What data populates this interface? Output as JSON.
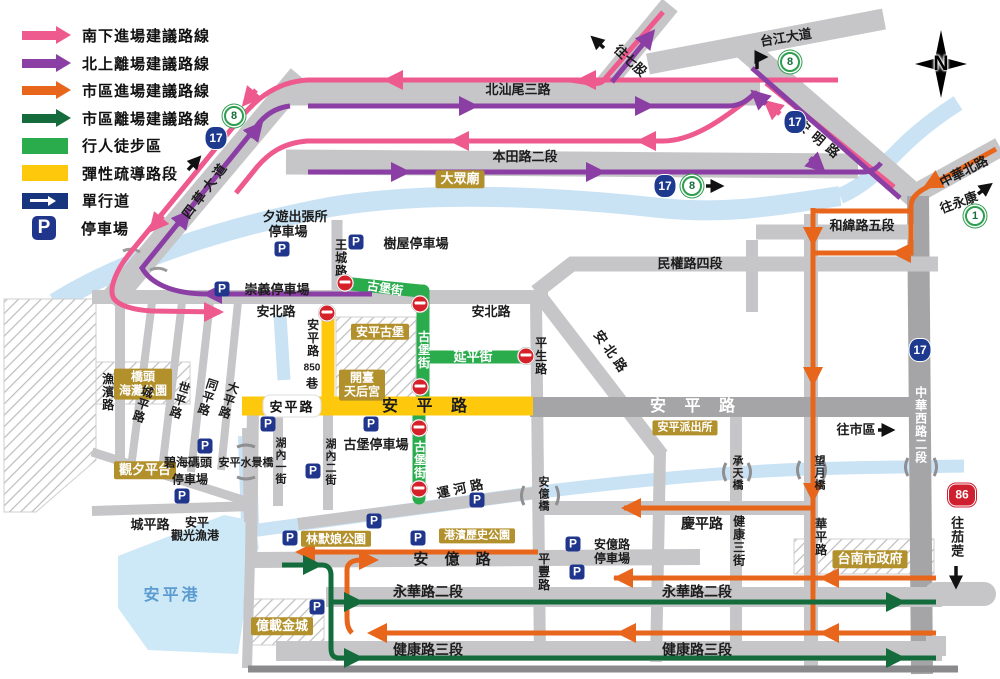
{
  "colors": {
    "pink": "#ee5a8e",
    "purple": "#8b3fa5",
    "orange": "#e8651c",
    "dark_green": "#146c3c",
    "pedestrian_green": "#2aac4d",
    "flex_yellow": "#fec80d",
    "oneway_navy": "#17357e",
    "parking_navy": "#20368c",
    "road_gray": "#c6c6c8",
    "water_blue": "#c9e3f5",
    "landmark_gold": "#b2902b",
    "noentry_red": "#d6202a"
  },
  "icons": {
    "parking": "P"
  },
  "compass": {
    "label": "N"
  },
  "shields": {
    "hw17": "17",
    "hw8": "8",
    "hw1": "1",
    "hw86": "86"
  },
  "legend": {
    "items": [
      {
        "label": "南下進場建議路線"
      },
      {
        "label": "北上離場建議路線"
      },
      {
        "label": "市區進場建議路線"
      },
      {
        "label": "市區離場建議路線"
      },
      {
        "label": "行人徒步區"
      },
      {
        "label": "彈性疏導路段"
      },
      {
        "label": "單行道"
      },
      {
        "label": "停車場"
      }
    ]
  },
  "labels": {
    "beishanwei": "北汕尾三路",
    "bentian": "本田路二段",
    "taijiang": "台江大道",
    "wangqigu": "往七股",
    "anming": "安明路",
    "sicao": "四草大道",
    "dazhong": "大眾廟",
    "zhonghuabei": "中華北路",
    "wangyongkang": "往永康",
    "hewei": "和緯路五段",
    "minquan": "民權路四段",
    "anbei1": "安北路",
    "anbei2": "安北路",
    "anbeid": "安北路",
    "chongyi": "崇義停車場",
    "xiyou1": "夕遊出張所",
    "xiyou2": "停車場",
    "wangcheng": "王城路",
    "shuwu": "樹屋停車場",
    "gubao_n": "古堡街",
    "gubao_v": "古堡街",
    "gubao_s": "古堡街",
    "yanping": "延平街",
    "pingsheng": "平生路",
    "l850a": "安平路",
    "l850b": "850",
    "l850c": "巷",
    "anpinggubao": "安平古堡",
    "kaitai1": "開臺",
    "kaitai2": "天后宮",
    "ap_box": "安平路",
    "ap_yellow": "安 平 路",
    "ap_east": "安 平 路",
    "paichusuo": "安平派出所",
    "wangshiqu": "往市區",
    "zhonghuaxi": "中華西路二段",
    "qiaotou1": "橋頭",
    "qiaotou2": "海灘公園",
    "yubin": "漁濱路",
    "chengping_d": "城平路",
    "shiping": "世平路",
    "tongping": "同平路",
    "daping": "大平路",
    "guanxi": "觀夕平台",
    "bihai1": "碧海碼頭",
    "bihai2": "停車場",
    "shuijing": "安平水景橋",
    "hunei1": "湖內一街",
    "hunei2": "湖內二街",
    "gubaoP": "古堡停車場",
    "chengping_h": "城平路",
    "guanguang1": "安平",
    "guanguang2": "觀光漁港",
    "anpinggang": "安平港",
    "yunhe": "運河路",
    "anyiqiao": "安億橋",
    "pingfeng": "平豐路",
    "anyilu": "安 億 路",
    "linmo": "林默娘公園",
    "gangbin": "港濱歷史公園",
    "anyiP1": "安億路",
    "anyiP2": "停車場",
    "qingping": "慶平路",
    "jk3jie": "健康三街",
    "chengtian": "承天橋",
    "wangyue": "望月橋",
    "huaping": "華平路",
    "yonghua1": "永華路二段",
    "yonghua2": "永華路二段",
    "jklu1": "健康路三段",
    "jklu2": "健康路三段",
    "gov": "台南市政府",
    "yizai": "億載金城",
    "qieding": "往茄萣"
  }
}
